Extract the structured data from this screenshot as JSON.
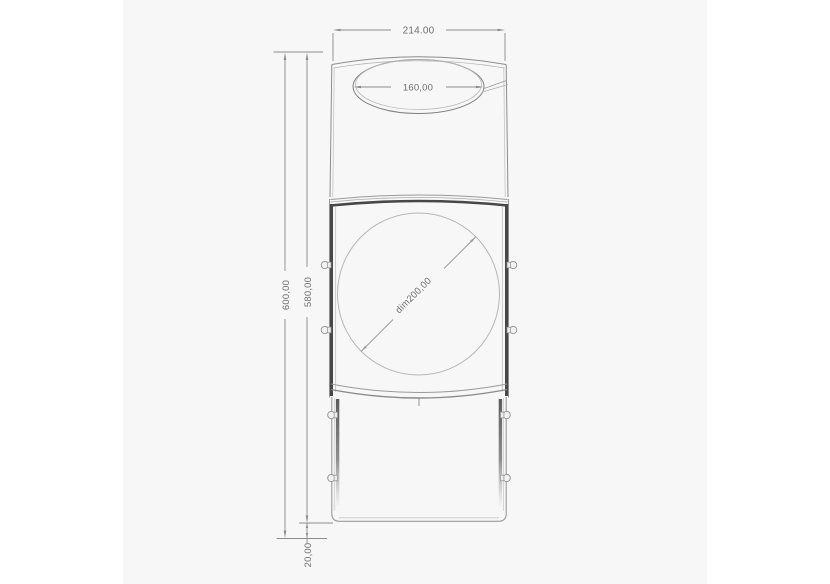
{
  "colors": {
    "page_background": "#ffffff",
    "canvas_background": "#f7f7f7",
    "outline": "#8c8c8c",
    "outline_light": "#c4c4c4",
    "frame_dark": "#474747",
    "thin_geometry": "#b6b6b6",
    "dimension_line": "#8c8c8c",
    "dimension_text": "#6e6e6e"
  },
  "dimensions": {
    "overall_width": "214.00",
    "opening_width": "160,00",
    "overall_height": "600,00",
    "body_height": "580,00",
    "base_clearance": "20,00",
    "door_circle_diameter": "dim200,00"
  }
}
